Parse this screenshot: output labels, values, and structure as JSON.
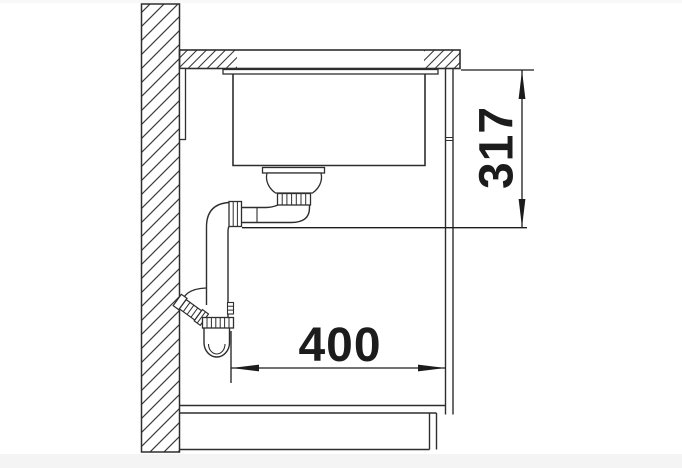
{
  "diagram": {
    "description": "side section installation drawing of an undermount sink in a base cabinet with drain trap",
    "dimensions": {
      "vertical": {
        "value": "317",
        "orientation": "vertical"
      },
      "horizontal": {
        "value": "400",
        "orientation": "horizontal"
      }
    },
    "colors": {
      "line": "#2e2e2e",
      "hatch": "#3a3a3a",
      "dimension": "#1c1c1c",
      "dimension_text": "#1c1c1c",
      "background": "#ffffff",
      "footer_bar": "#f4f4f4",
      "top_strip": "#f8f8f8"
    }
  }
}
